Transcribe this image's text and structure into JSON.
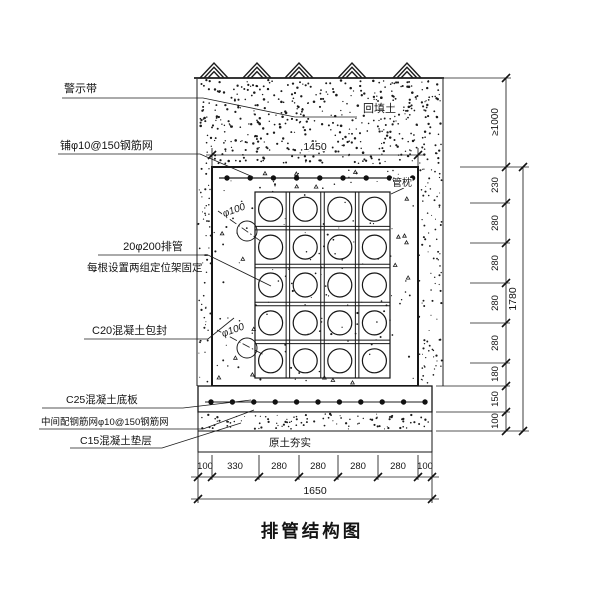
{
  "title": "排管结构图",
  "labels": {
    "warning_tape": "警示带",
    "top_mesh": "铺φ10@150钢筋网",
    "backfill": "回填土",
    "pipes": "20φ200排管",
    "pipes_note": "每根设置两组定位架固定",
    "encasement": "C20混凝土包封",
    "pipe_pillow": "管枕",
    "pipe_diameter": "φ100",
    "base_slab": "C25混凝土底板",
    "slab_mesh": "中间配钢筋网φ10@150钢筋网",
    "cushion": "C15混凝土垫层",
    "compacted_soil": "原土夯实"
  },
  "dims": {
    "top_width": "1450",
    "bottom_segments": [
      "100",
      "330",
      "280",
      "280",
      "280",
      "280",
      "100"
    ],
    "bottom_total": "1650",
    "right_cover": "≥1000",
    "right_segments": [
      "230",
      "280",
      "280",
      "280",
      "280",
      "180",
      "150",
      "100"
    ],
    "right_total": "1780"
  },
  "diagram": {
    "type": "duct-bank-cross-section",
    "pipe_rows": 5,
    "pipe_columns": 4,
    "pipe_count": 20
  }
}
